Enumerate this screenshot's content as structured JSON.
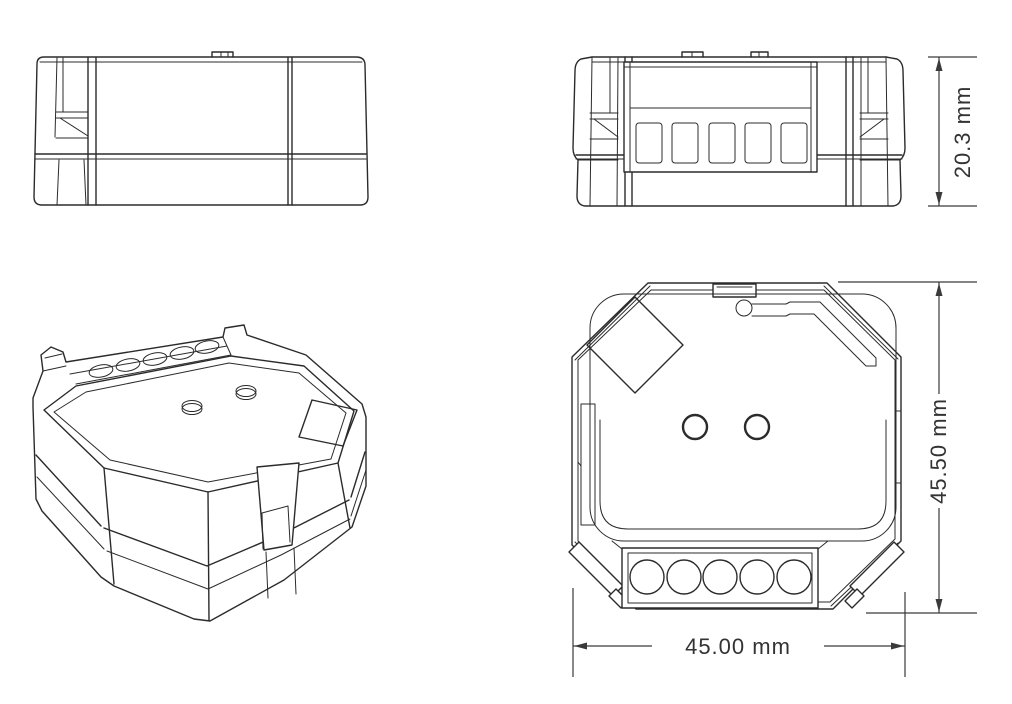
{
  "drawing": {
    "background": "#ffffff",
    "line_color": "#2b2b2b",
    "text_color": "#333333",
    "dimensions": {
      "height": "20.3 mm",
      "depth": "45.50 mm",
      "width": "45.00 mm"
    },
    "views": {
      "side": "side-elevation-view",
      "front": "front-view-with-terminal-block",
      "isometric": "isometric-view",
      "top": "top-view"
    },
    "front_view": {
      "terminal_slot_count": 5
    },
    "top_view": {
      "terminal_hole_count": 5,
      "button_count": 2
    }
  }
}
